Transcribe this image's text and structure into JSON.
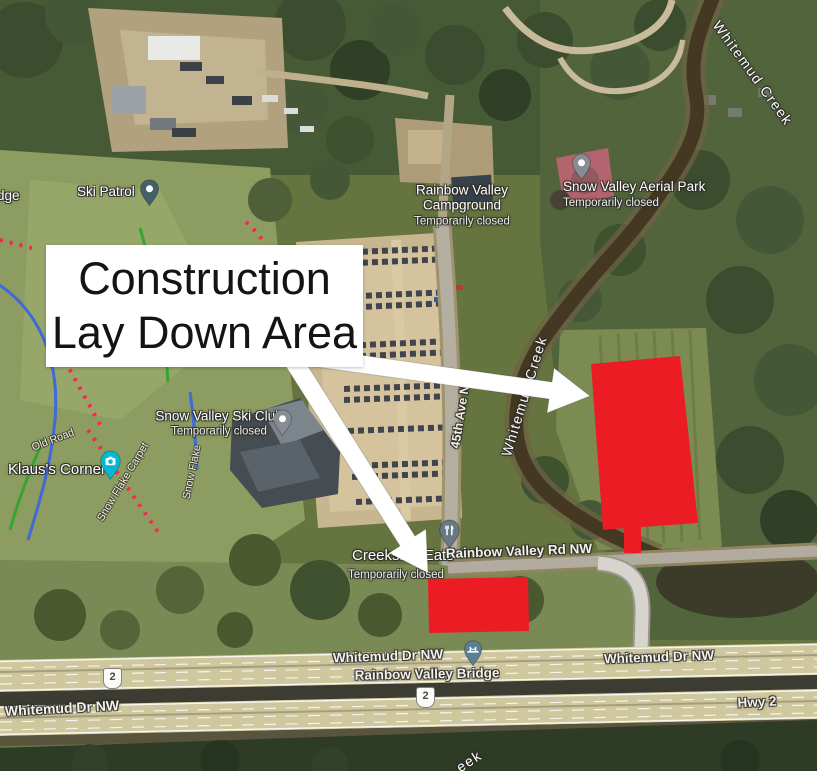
{
  "annotation": {
    "title_line1": "Construction",
    "title_line2": "Lay Down Area"
  },
  "labels": {
    "ridge_partial": "dge",
    "ski_patrol": "Ski Patrol",
    "campground_line1": "Rainbow Valley",
    "campground_line2": "Campground",
    "campground_status": "Temporarily closed",
    "aerial_park": "Snow Valley Aerial Park",
    "aerial_park_status": "Temporarily closed",
    "ski_club": "Snow Valley Ski Club",
    "ski_club_status": "Temporarily closed",
    "klaus_corner": "Klaus's Corner",
    "old_road": "Old Road",
    "snow_flake_carpet": "Snow Flake Carpet",
    "snow_flake": "Snow Flake",
    "creek_top": "Whitemud Creek",
    "creek_mid": "Whitemud Creek",
    "creek_bottom_partial": "eek",
    "ave_45th": "45th Ave NW",
    "creekside_eats": "Creekside Eats",
    "creekside_eats_status": "Temporarily closed",
    "rainbow_valley_rd": "Rainbow Valley Rd NW",
    "whitemud_dr_bridge": "Whitemud Dr NW",
    "rainbow_valley_bridge": "Rainbow Valley Bridge",
    "whitemud_dr_left": "Whitemud Dr NW",
    "whitemud_dr_right": "Whitemud Dr NW",
    "hwy2": "Hwy 2",
    "shield_left": "2",
    "shield_mid": "2"
  },
  "icons": {
    "poi_pin": "map pin with white dot",
    "camera_pin": "map pin with camera glyph",
    "restaurant_pin": "map pin with fork and knife glyph",
    "bridge_pin": "map pin with bridge glyph",
    "route_shield": "highway route shield"
  },
  "colors": {
    "area_red": "#ec1c24",
    "arrow": "#ffffff",
    "box_bg": "#ffffff",
    "box_text": "#141414",
    "pin_slate": "#44606b",
    "pin_gray": "#878d92",
    "pin_teal": "#00b9d4",
    "pin_restaurant": "#697984",
    "pin_bridge": "#5b7f95"
  }
}
